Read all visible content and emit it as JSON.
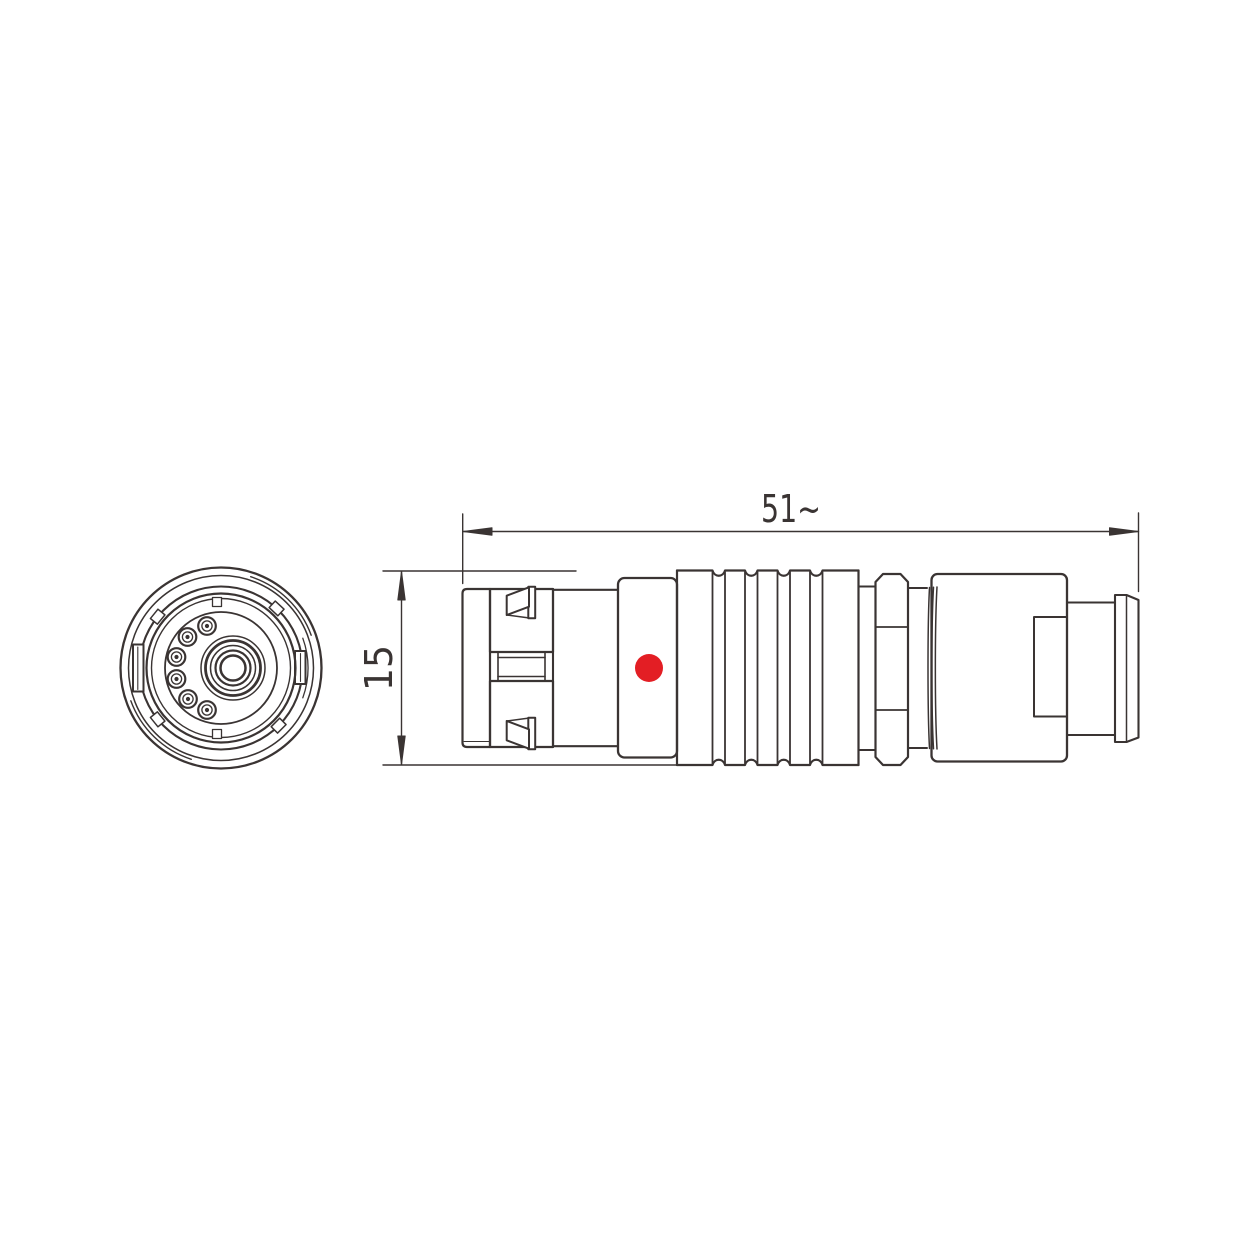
{
  "drawing": {
    "dimension_labels": {
      "length": "51~",
      "diameter": "15"
    },
    "colors": {
      "line": "#3a3433",
      "accent_dot": "#e31e24",
      "background": "#ffffff"
    }
  }
}
